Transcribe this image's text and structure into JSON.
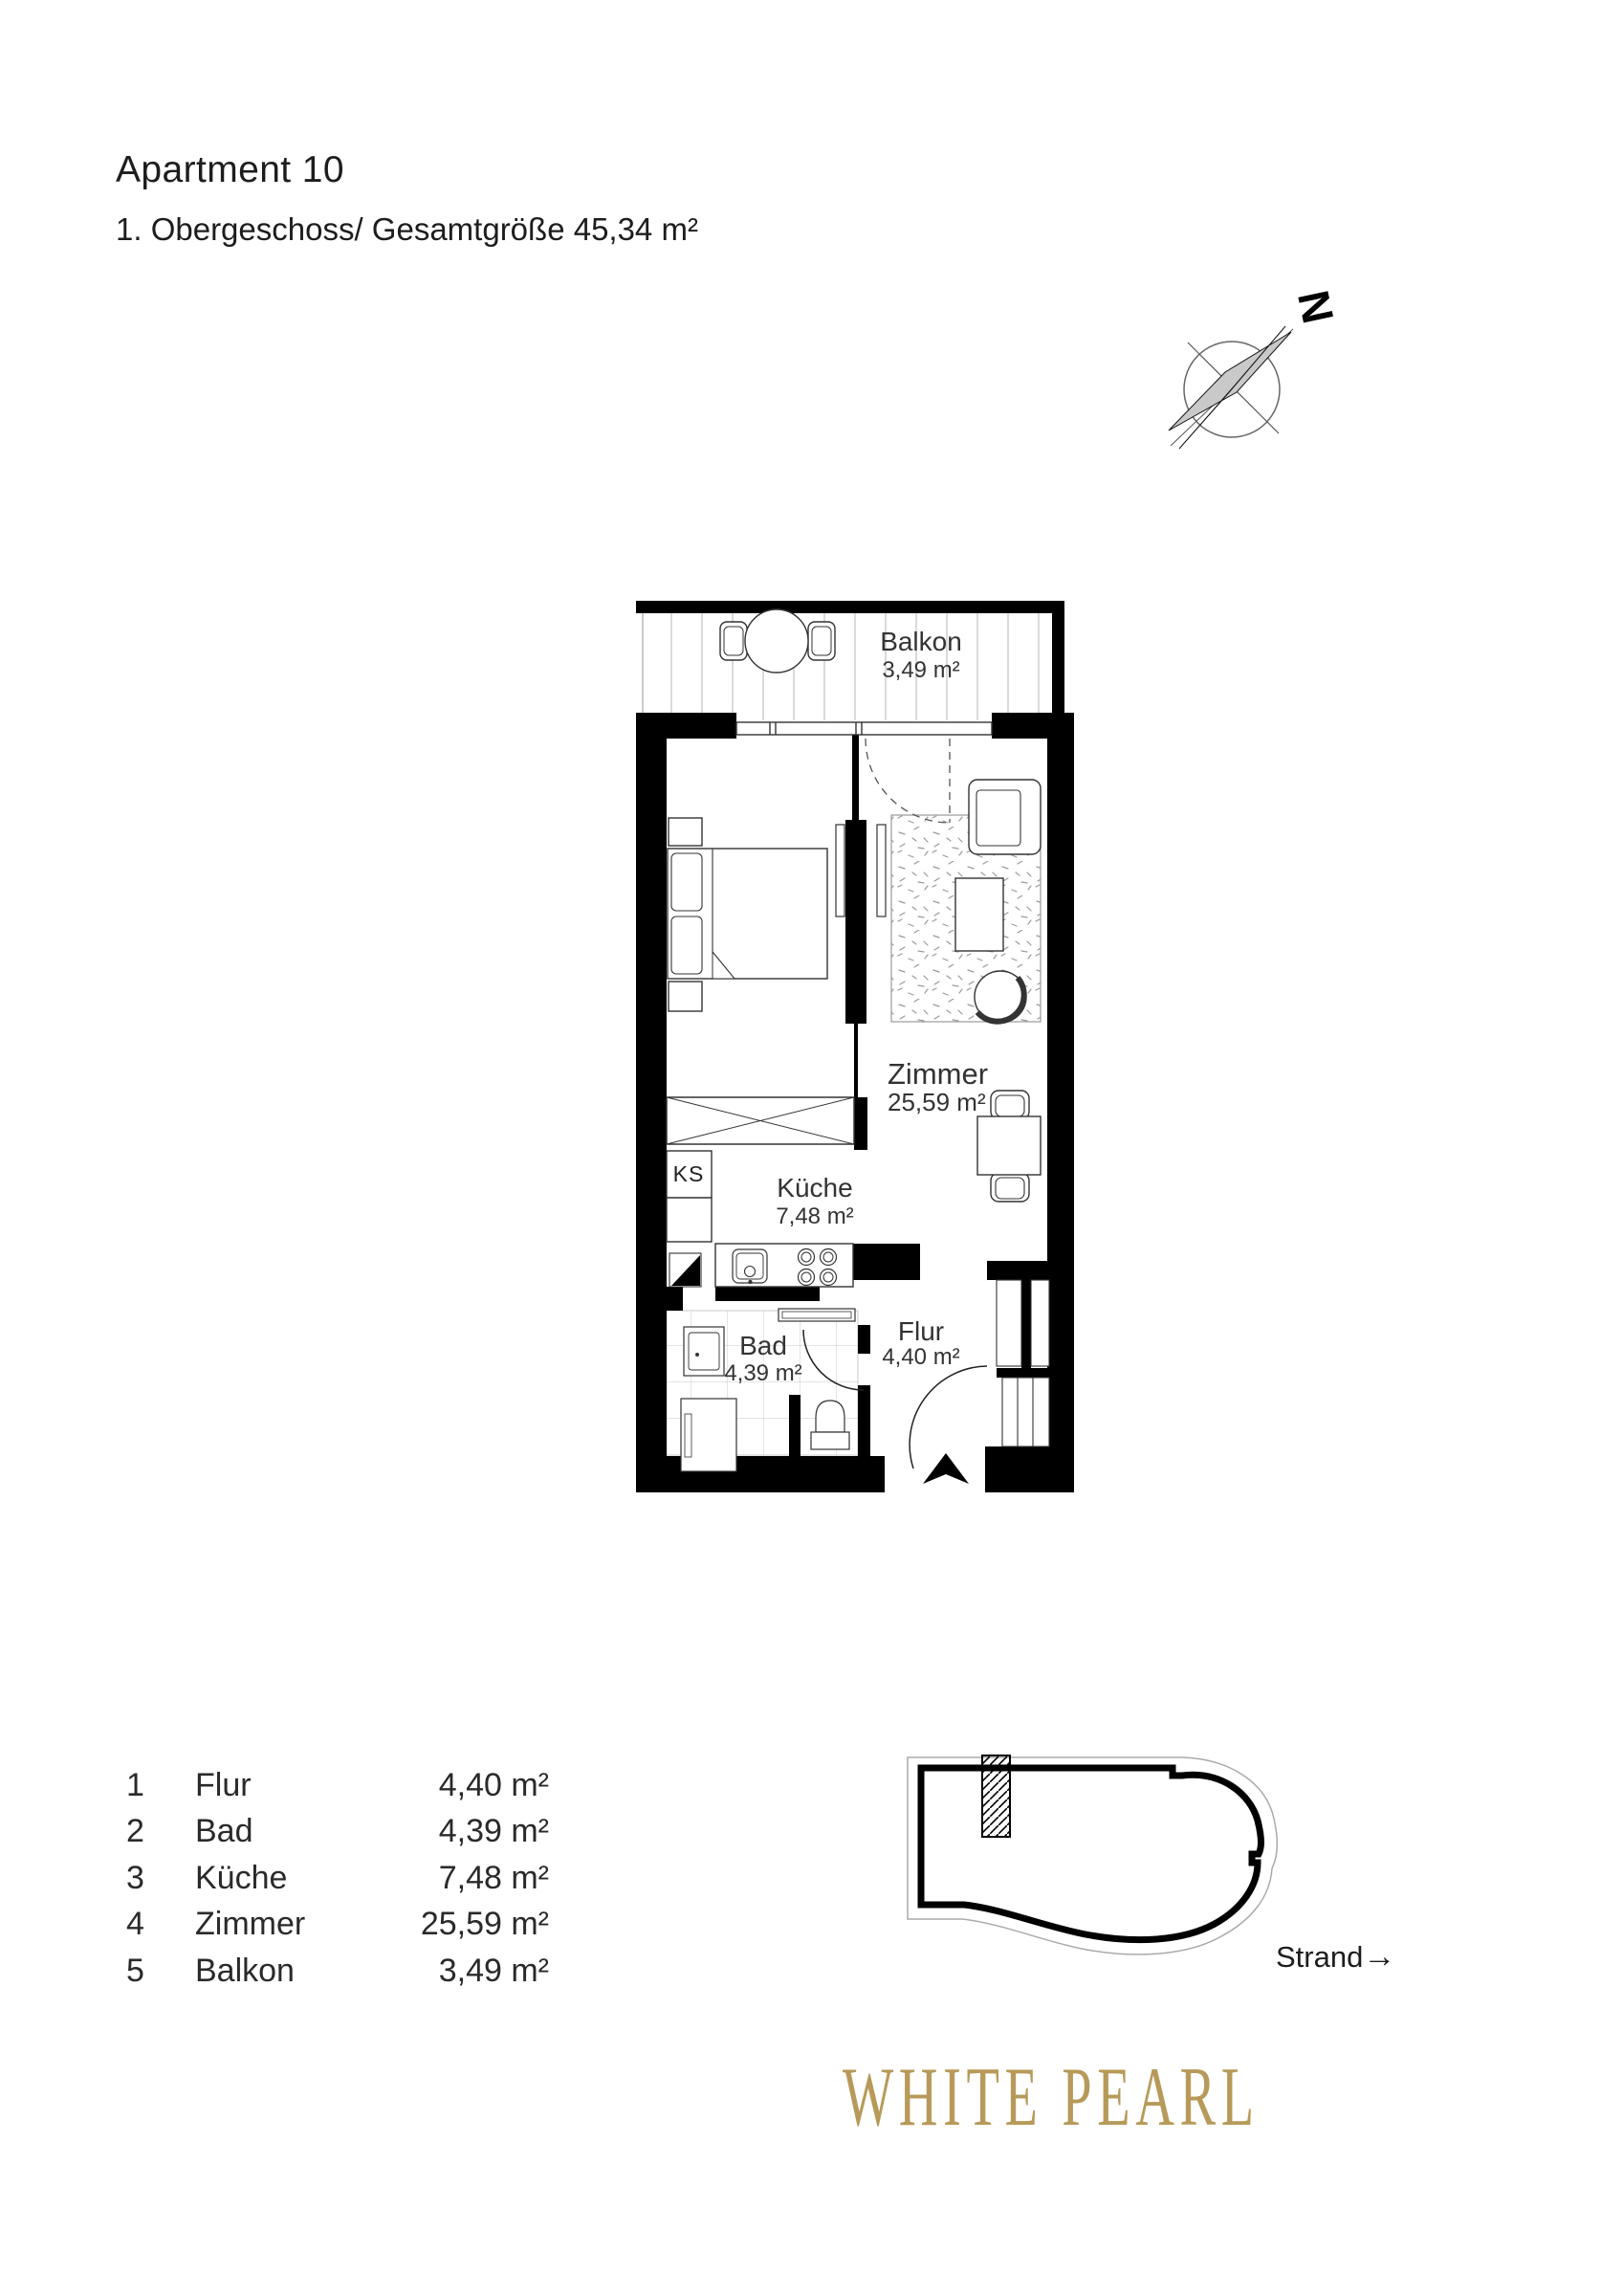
{
  "header": {
    "title": "Apartment 10",
    "subtitle": "1. Obergeschoss/ Gesamtgröße 45,34 m²"
  },
  "compass": {
    "north_label": "N"
  },
  "floorplan": {
    "balkon_name": "Balkon",
    "balkon_area": "3,49 m²",
    "zimmer_name": "Zimmer",
    "zimmer_area": "25,59 m²",
    "kueche_name": "Küche",
    "kueche_area": "7,48 m²",
    "bad_name": "Bad",
    "bad_area": "4,39 m²",
    "flur_name": "Flur",
    "flur_area": "4,40 m²",
    "fridge_label": "KS"
  },
  "legend": {
    "rows": [
      {
        "num": "1",
        "name": "Flur",
        "area": "4,40 m²"
      },
      {
        "num": "2",
        "name": "Bad",
        "area": "4,39 m²"
      },
      {
        "num": "3",
        "name": "Küche",
        "area": "7,48 m²"
      },
      {
        "num": "4",
        "name": "Zimmer",
        "area": "25,59 m²"
      },
      {
        "num": "5",
        "name": "Balkon",
        "area": "3,49 m²"
      }
    ]
  },
  "siteplan": {
    "strand_label": "Strand",
    "strand_arrow": "→"
  },
  "brand": {
    "name": "WHITE PEARL",
    "color": "#B79A59"
  }
}
